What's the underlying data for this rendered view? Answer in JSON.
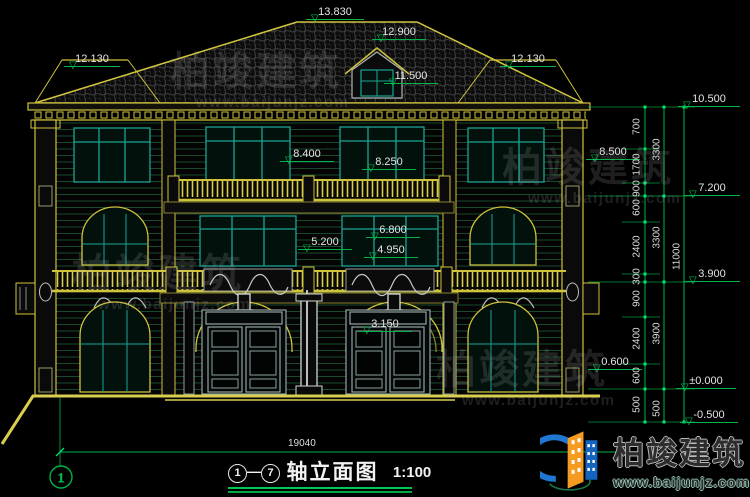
{
  "drawing": {
    "title": "轴立面图",
    "scale": "1:100",
    "axis_from": "1",
    "axis_to": "7",
    "axis_separator": "—",
    "axis_bubble_left": "1",
    "bottom_overall_dim": "19040"
  },
  "levels": [
    {
      "label": "13.830",
      "x": 306,
      "y": 6,
      "w": 58
    },
    {
      "label": "12.130",
      "x": 64,
      "y": 53,
      "w": 56
    },
    {
      "label": "12.900",
      "x": 372,
      "y": 26,
      "w": 54
    },
    {
      "label": "11.500",
      "x": 384,
      "y": 70,
      "w": 54
    },
    {
      "label": "12.130",
      "x": 500,
      "y": 53,
      "w": 56
    },
    {
      "label": "10.500",
      "x": 678,
      "y": 93,
      "w": 62
    },
    {
      "label": "8.500",
      "x": 586,
      "y": 146,
      "w": 54
    },
    {
      "label": "8.400",
      "x": 280,
      "y": 148,
      "w": 54
    },
    {
      "label": "8.250",
      "x": 362,
      "y": 156,
      "w": 54
    },
    {
      "label": "7.200",
      "x": 684,
      "y": 182,
      "w": 56
    },
    {
      "label": "6.800",
      "x": 366,
      "y": 224,
      "w": 54
    },
    {
      "label": "5.200",
      "x": 298,
      "y": 236,
      "w": 54
    },
    {
      "label": "4.950",
      "x": 364,
      "y": 244,
      "w": 54
    },
    {
      "label": "3.900",
      "x": 684,
      "y": 268,
      "w": 56
    },
    {
      "label": "3.150",
      "x": 358,
      "y": 318,
      "w": 54
    },
    {
      "label": "0.600",
      "x": 588,
      "y": 356,
      "w": 54
    },
    {
      "label": "±0.000",
      "x": 676,
      "y": 375,
      "w": 60
    },
    {
      "label": "-0.500",
      "x": 680,
      "y": 409,
      "w": 58
    }
  ],
  "vertical_dim_columns": [
    {
      "x": 637,
      "items": [
        {
          "label": "700",
          "y": 128
        },
        {
          "label": "1700",
          "y": 166
        },
        {
          "label": "900",
          "y": 190
        },
        {
          "label": "600",
          "y": 209
        },
        {
          "label": "2400",
          "y": 248
        },
        {
          "label": "300",
          "y": 278
        },
        {
          "label": "900",
          "y": 300
        },
        {
          "label": "2400",
          "y": 340
        },
        {
          "label": "600",
          "y": 377
        },
        {
          "label": "500",
          "y": 406
        }
      ]
    },
    {
      "x": 657,
      "items": [
        {
          "label": "3300",
          "y": 151
        },
        {
          "label": "3300",
          "y": 239
        },
        {
          "label": "3900",
          "y": 335
        },
        {
          "label": "500",
          "y": 410
        }
      ]
    },
    {
      "x": 677,
      "items": [
        {
          "label": "11000",
          "y": 258
        }
      ]
    }
  ],
  "watermarks": {
    "company": "柏竣建筑",
    "url": "www.baijunjz.com",
    "positions": [
      {
        "x": 170,
        "y": 52
      },
      {
        "x": 502,
        "y": 148
      },
      {
        "x": 72,
        "y": 254
      },
      {
        "x": 436,
        "y": 350
      }
    ]
  },
  "logo": {
    "company": "柏竣建筑",
    "url": "www.baijunjz.com"
  },
  "colors": {
    "dimension_green": "#00b448",
    "trim_yellow": "#d9ce4f",
    "glazing_teal": "#1ba393",
    "roof_hatch_gray": "#404040",
    "text_white": "#e4e4e4",
    "logo_blue": "#1e78d2",
    "logo_orange": "#f59b22"
  }
}
